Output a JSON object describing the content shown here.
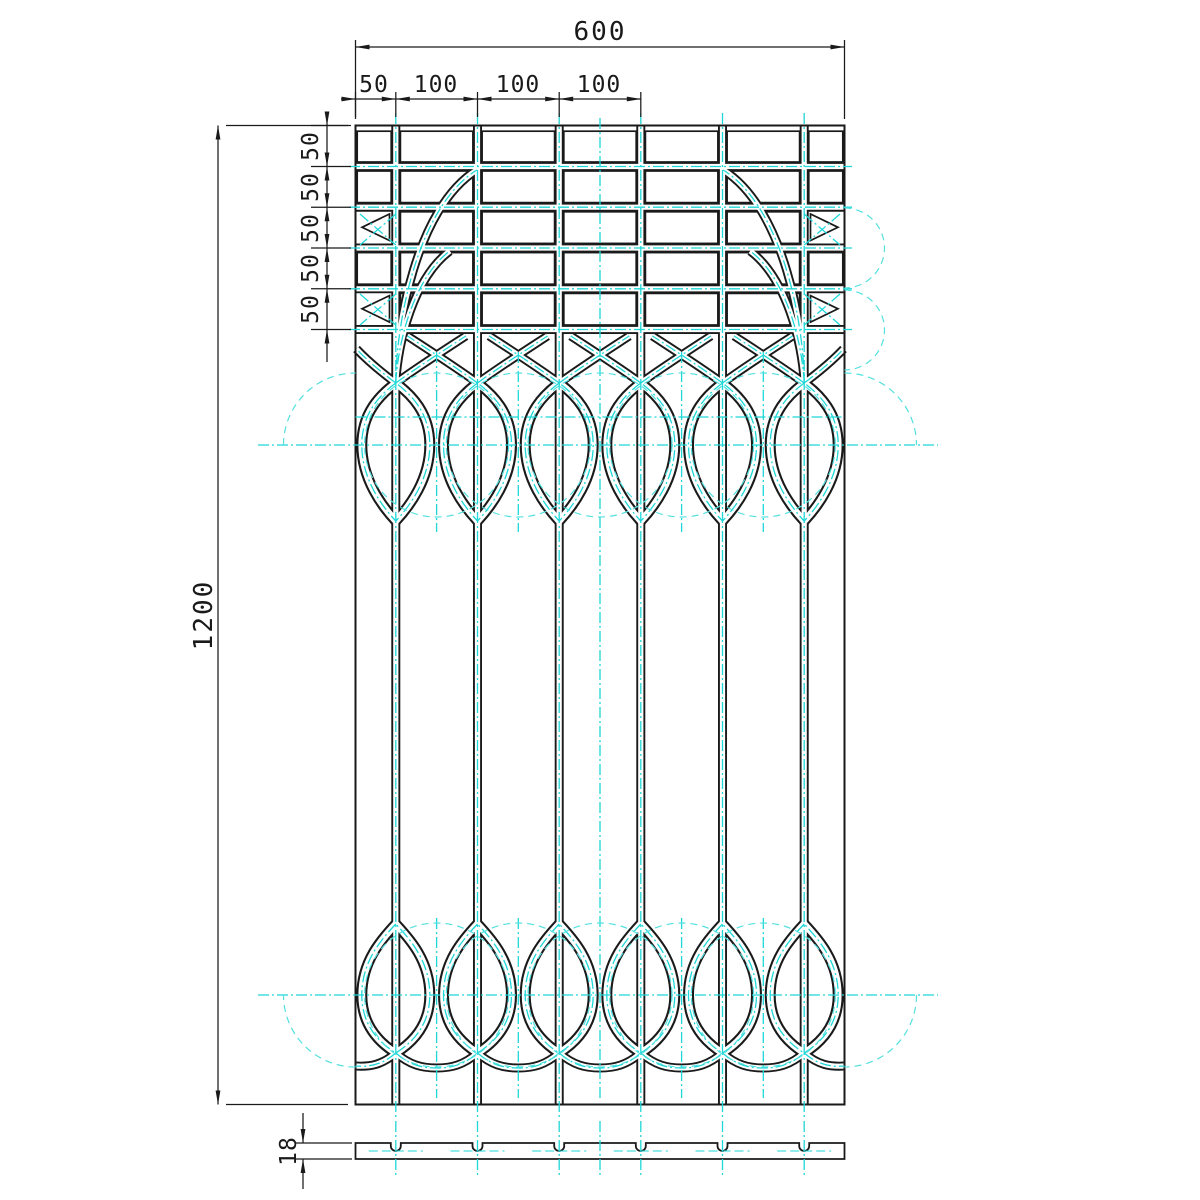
{
  "dimensions": {
    "total_width": "600",
    "width_chain": [
      "50",
      "100",
      "100",
      "100"
    ],
    "total_height": "1200",
    "height_chain": [
      "50",
      "50",
      "50",
      "50",
      "50"
    ],
    "section_thickness": "18"
  },
  "colors": {
    "line": "#1a1a1a",
    "centerline": "#1fd7d7",
    "construction": "#55e0e0",
    "background": "#ffffff"
  }
}
